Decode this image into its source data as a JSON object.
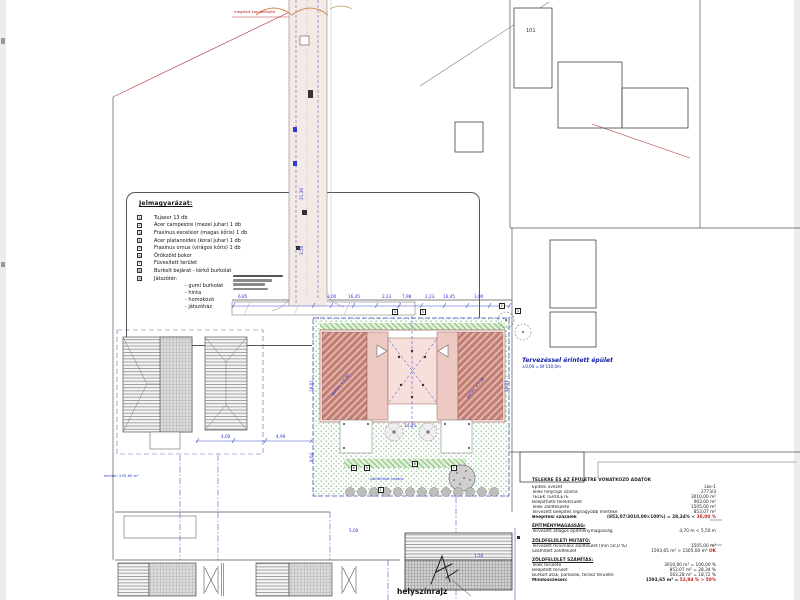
{
  "page": {
    "caption": "helyszínrajz"
  },
  "legend": {
    "title": "Jelmagyarázat:",
    "items": [
      {
        "num": "1",
        "text": "Tujasor 13 db"
      },
      {
        "num": "2",
        "text": "Acer campestre (mezei juhar) 1 db"
      },
      {
        "num": "3",
        "text": "Fraxinus excelsior (magas kőris) 1 db"
      },
      {
        "num": "4",
        "text": "Acer platanoides (korai juhar) 1 db"
      },
      {
        "num": "5",
        "text": "Fraxinus ornus (virágos kőris) 1 db"
      },
      {
        "num": "6",
        "text": "Örökzöld bokor"
      },
      {
        "num": "7",
        "text": "Füvesített terület"
      },
      {
        "num": "8",
        "text": "Burkolt bejárat - térkő burkolat"
      },
      {
        "num": "9",
        "text": "Játszótér:"
      }
    ],
    "sub_items": [
      "- gumi burkolat",
      "- hinta",
      "- homokozó",
      "- játszóház"
    ]
  },
  "annotations": {
    "building_label": "Tervezéssel érintett épület",
    "building_level": "±0,00 = Bf 110,0m",
    "red_note": "meglévő kapubehajtó",
    "area_note": "terület: 535,60 m²",
    "parcel_number": "101",
    "green_note": "zöldfelület határa",
    "roof_ridge_left": "gerinc +7,39",
    "roof_ridge_right": "gerinc +7,39"
  },
  "dimensions": [
    {
      "text": "6,85",
      "x": 238,
      "y": 294
    },
    {
      "text": "3,00",
      "x": 327,
      "y": 294
    },
    {
      "text": "16,45",
      "x": 348,
      "y": 294
    },
    {
      "text": "2,23",
      "x": 382,
      "y": 294
    },
    {
      "text": "7,98",
      "x": 402,
      "y": 294
    },
    {
      "text": "2,23",
      "x": 425,
      "y": 294
    },
    {
      "text": "16,45",
      "x": 443,
      "y": 294
    },
    {
      "text": "3,00",
      "x": 474,
      "y": 294
    },
    {
      "text": "18,01",
      "x": 309,
      "y": 392,
      "rot": -90
    },
    {
      "text": "8,64",
      "x": 309,
      "y": 462,
      "rot": -90
    },
    {
      "text": "18,01",
      "x": 504,
      "y": 392,
      "rot": -90
    },
    {
      "text": "14,05",
      "x": 404,
      "y": 423
    },
    {
      "text": "4,00",
      "x": 221,
      "y": 434
    },
    {
      "text": "4,99",
      "x": 276,
      "y": 434
    },
    {
      "text": "5,00",
      "x": 349,
      "y": 528
    },
    {
      "text": "1,50",
      "x": 474,
      "y": 553
    },
    {
      "text": "21,36",
      "x": 299,
      "y": 200,
      "rot": -90
    },
    {
      "text": "3,50",
      "x": 299,
      "y": 255,
      "rot": -90
    }
  ],
  "markers": [
    {
      "num": "1",
      "x": 378,
      "y": 487
    },
    {
      "num": "8",
      "x": 351,
      "y": 465
    },
    {
      "num": "9",
      "x": 364,
      "y": 465
    },
    {
      "num": "6",
      "x": 412,
      "y": 461
    },
    {
      "num": "7",
      "x": 451,
      "y": 465
    },
    {
      "num": "2",
      "x": 499,
      "y": 303
    },
    {
      "num": "3",
      "x": 515,
      "y": 308
    },
    {
      "num": "4",
      "x": 392,
      "y": 309
    },
    {
      "num": "5",
      "x": 420,
      "y": 309
    }
  ],
  "table": {
    "title": "TELEKRE ÉS AZ ÉPÜLETRE VONATKOZÓ ADATOK",
    "sections": [
      {
        "heading": "",
        "rows": [
          {
            "label": "Építési övezet",
            "value": "Lke-1"
          },
          {
            "label": "Telek helyrajzi száma",
            "value": "2773/3"
          },
          {
            "label": "TELEK TERÜLETE",
            "value": "3010,00 m²"
          },
          {
            "label": "Beépíthető telekterület",
            "value": "903,00 m²"
          },
          {
            "label": "Telek zöldfelülete",
            "value": "1505,00 m²"
          },
          {
            "label": "Tervezett beépítés legnagyobb mértéke",
            "value": "853,07 m²"
          },
          {
            "label": "Beépítési százalék",
            "value": "(853,07/3010,00×100%) = 28,34% <",
            "red": "30,00 %",
            "bold": true
          }
        ]
      },
      {
        "heading": "ÉPÍTMÉNYMAGASSÁG:",
        "rows": [
          {
            "label": "Tervezett átlagos építménymagasság",
            "value": "4,70 m < 5,50 m"
          }
        ]
      },
      {
        "heading": "ZÖLDFELÜLETI MUTATÓ:",
        "rows": [
          {
            "label": "Tervezett minimális zöldfelület (min 50,0 %)",
            "value": "1505,00 m²"
          },
          {
            "label": "Számított zöldfelület",
            "value": "1593,65 m² > 1505,00 m²",
            "red": "OK"
          }
        ]
      },
      {
        "heading": "ZÖLDFELÜLET SZÁMÍTÁS:",
        "rows": [
          {
            "label": "Telek területe",
            "value": "3010,00 m² = 100,00 %"
          },
          {
            "label": "Beépített terület",
            "value": "853,07 m² = 28,34 %"
          },
          {
            "label": "Burkolt utak, parkolók, terasz területe",
            "value": "563,28 m² = 18,72 %"
          },
          {
            "label": "Mindösszesen:",
            "value": "1593,65 m² =",
            "red": "52,94 % > 50%",
            "bold": true
          }
        ]
      }
    ]
  },
  "colors": {
    "annotation_blue": "#2a3bd0",
    "alert_red": "#c22222",
    "lawn_green": "#7cb87c",
    "roof_red": "#c07e74",
    "road_fill": "#f4e9e5"
  }
}
